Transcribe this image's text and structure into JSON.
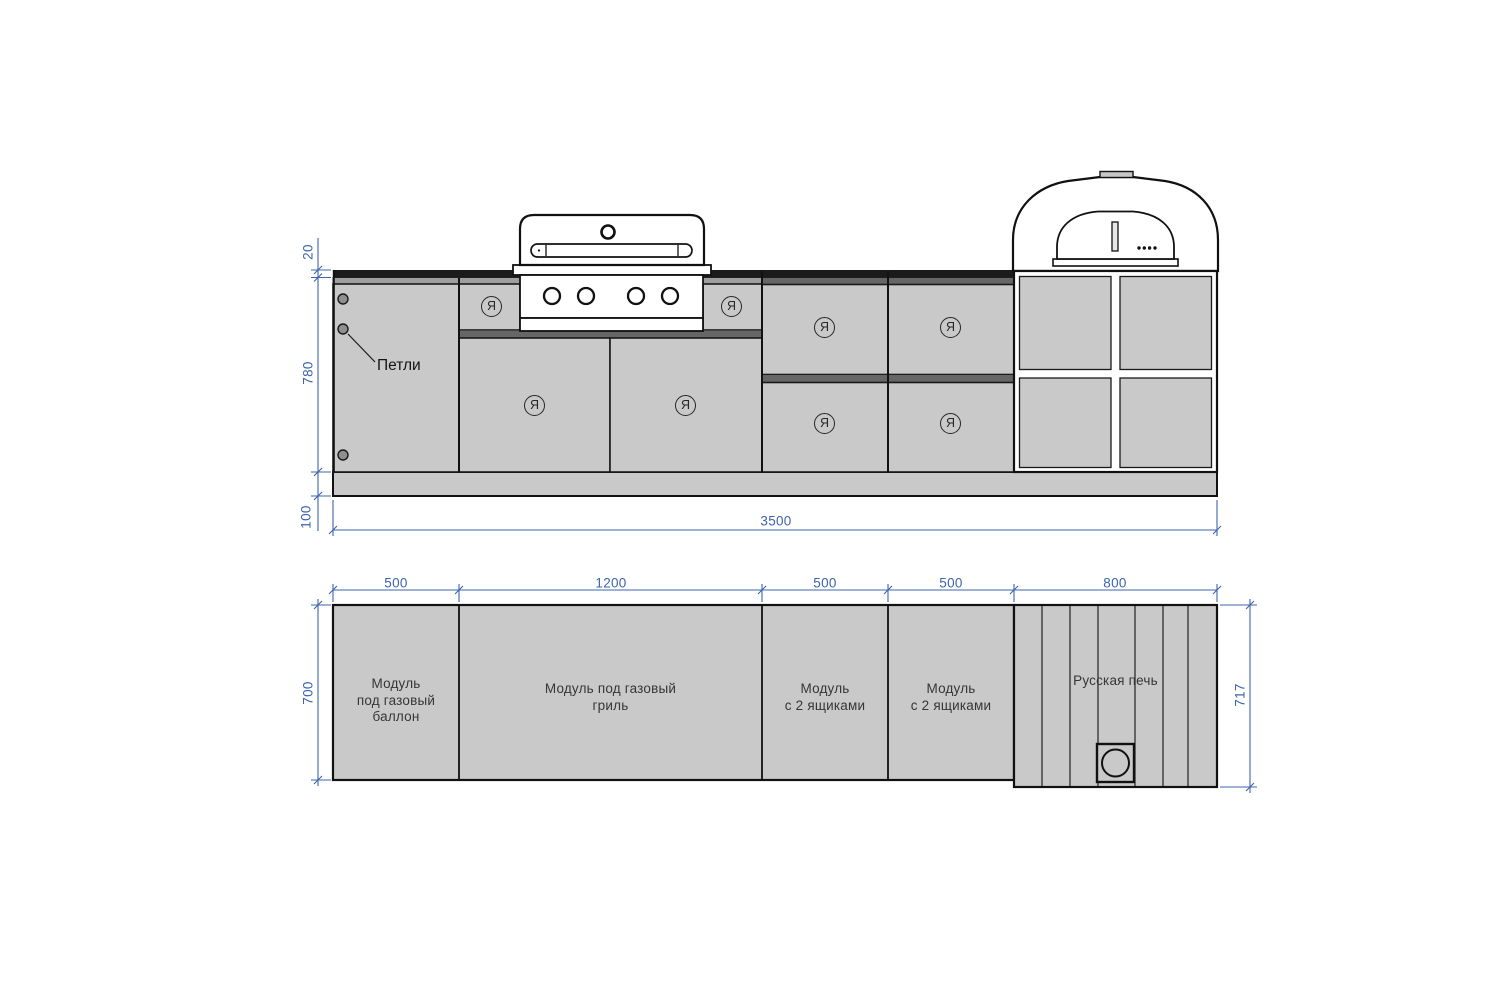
{
  "elevation": {
    "hinge_label": "Петли",
    "door_marker": "Я",
    "dims": {
      "countertop_thickness": "20",
      "front_height": "780",
      "plinth_height": "100",
      "total_width": "3500"
    }
  },
  "plan": {
    "dims": {
      "widths": [
        "500",
        "1200",
        "500",
        "500",
        "800"
      ],
      "depth_left": "700",
      "depth_right": "717"
    },
    "modules": [
      {
        "lines": [
          "Модуль",
          "под газовый",
          "баллон"
        ]
      },
      {
        "lines": [
          "Модуль под газовый",
          "гриль"
        ]
      },
      {
        "lines": [
          "Модуль",
          "с 2 ящиками"
        ]
      },
      {
        "lines": [
          "Модуль",
          "с 2 ящиками"
        ]
      },
      {
        "lines": [
          "Русская печь"
        ]
      }
    ]
  },
  "colors": {
    "dimension_blue": "#3c64ae",
    "panel_gray": "#c9c9c9",
    "countertop_dark": "#1b1b1b",
    "rail_gray": "#666666",
    "outline_black": "#111111"
  }
}
